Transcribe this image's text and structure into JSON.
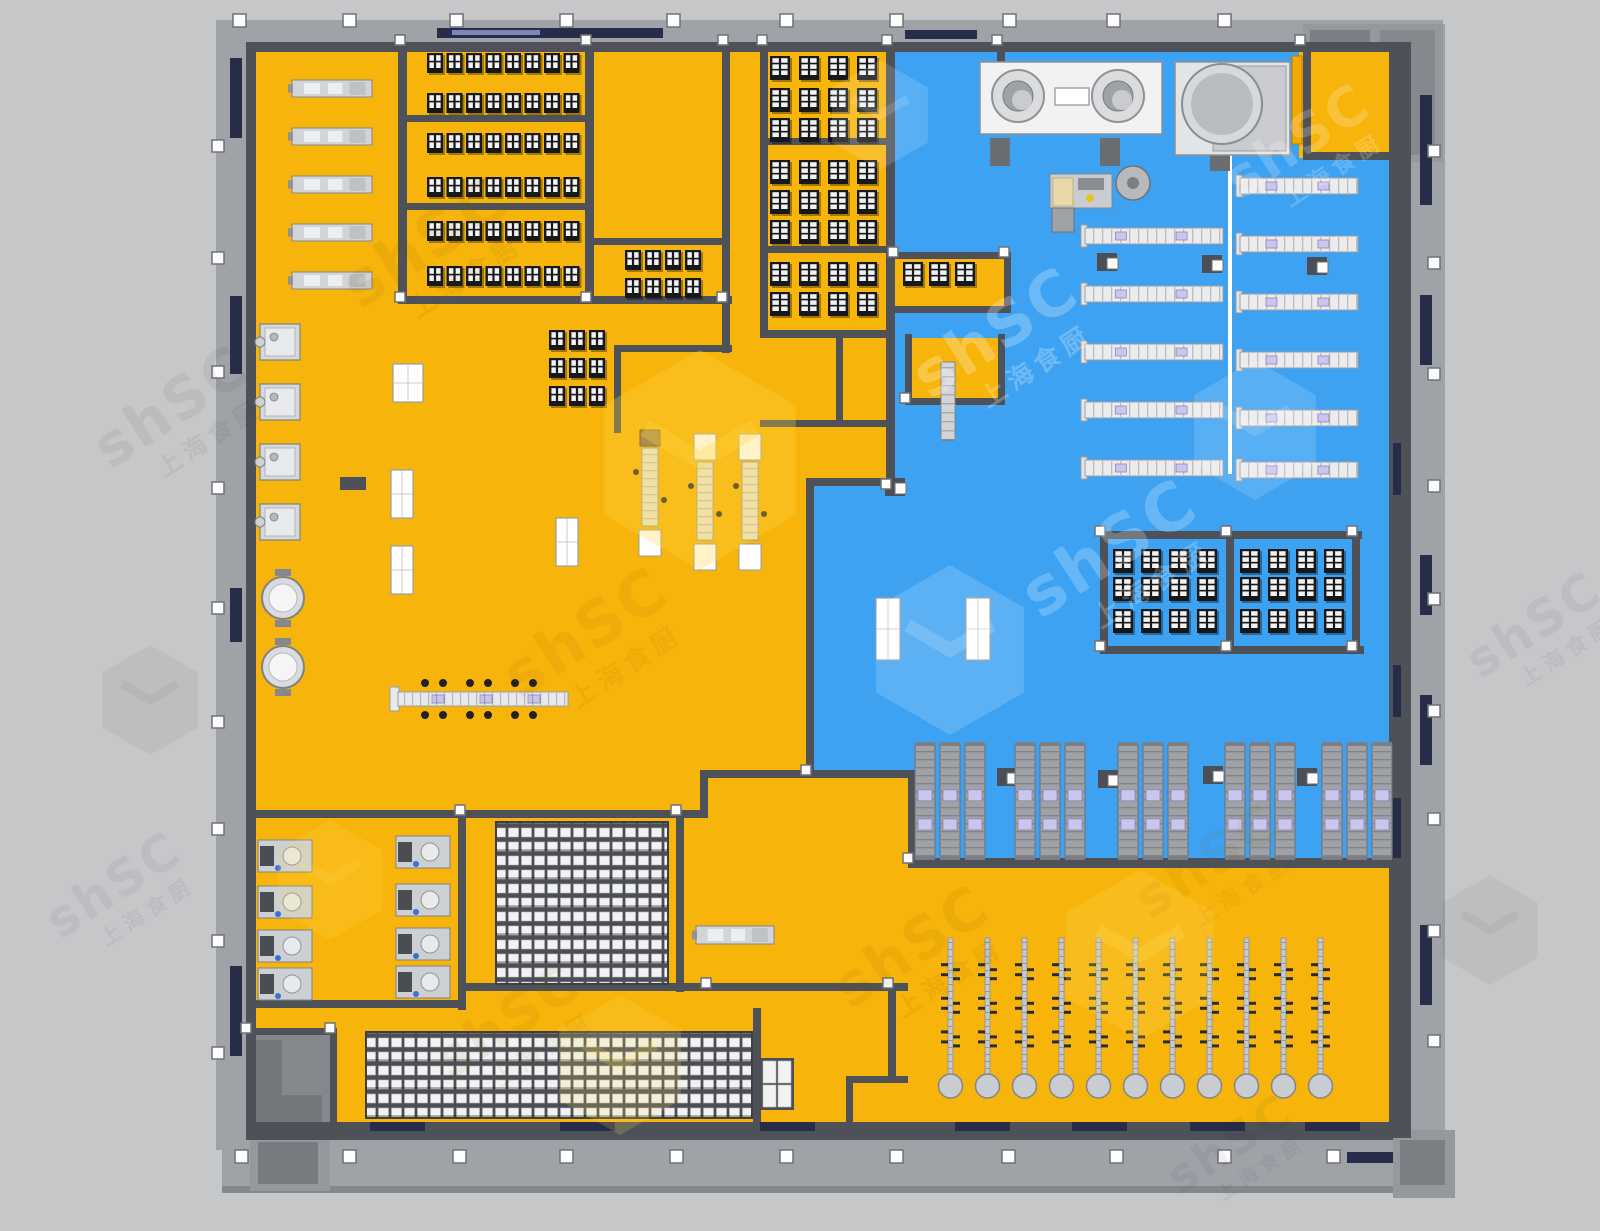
{
  "meta": {
    "width": 1600,
    "height": 1231,
    "bg": "#c6c7c9",
    "scene": "commercial-kitchen-floorplan-render"
  },
  "palette": {
    "yellow": "#F7B40A",
    "blue": "#3DA2F2",
    "wallDark": "#4E5258",
    "wallMid": "#6E7277",
    "facade": "#9FA2A7",
    "facadeDark": "#84878C",
    "navy": "#272C49",
    "white": "#FFFFFF",
    "silver": "#D2D4D7",
    "silverEdge": "#83868B",
    "rangeDark": "#17181A",
    "paneWhite": "#F2F2F3",
    "lavender": "#CBC6EE",
    "beige": "#EDE6D2",
    "trolley": "#9FA2A7",
    "colStroke": "#6E7176"
  },
  "watermark": {
    "latin": "shSC",
    "cjk": "上海食厨",
    "instances": [
      {
        "x": 110,
        "y": 470,
        "rot": -33,
        "size": 58,
        "color": "rgba(40,40,45,0.07)"
      },
      {
        "x": 360,
        "y": 310,
        "rot": -33,
        "size": 62,
        "color": "rgba(125,85,0,0.09)"
      },
      {
        "x": 520,
        "y": 700,
        "rot": -33,
        "size": 62,
        "color": "rgba(125,85,0,0.08)"
      },
      {
        "x": 930,
        "y": 400,
        "rot": -33,
        "size": 62,
        "color": "rgba(255,255,255,0.25)"
      },
      {
        "x": 1040,
        "y": 620,
        "rot": -33,
        "size": 66,
        "color": "rgba(255,255,255,0.22)"
      },
      {
        "x": 1240,
        "y": 200,
        "rot": -33,
        "size": 54,
        "color": "rgba(255,255,255,0.20)"
      },
      {
        "x": 850,
        "y": 1010,
        "rot": -33,
        "size": 58,
        "color": "rgba(125,85,0,0.09)"
      },
      {
        "x": 1150,
        "y": 920,
        "rot": -33,
        "size": 54,
        "color": "rgba(125,85,0,0.07)"
      },
      {
        "x": 450,
        "y": 1080,
        "rot": -33,
        "size": 54,
        "color": "rgba(125,85,0,0.08)"
      },
      {
        "x": 1480,
        "y": 680,
        "rot": -33,
        "size": 50,
        "color": "rgba(40,40,45,0.06)"
      },
      {
        "x": 60,
        "y": 940,
        "rot": -33,
        "size": 50,
        "color": "rgba(40,40,45,0.06)"
      },
      {
        "x": 1180,
        "y": 1195,
        "rot": -33,
        "size": 46,
        "color": "rgba(40,40,45,0.06)"
      }
    ],
    "cubes": [
      {
        "x": 700,
        "y": 460,
        "s": 110,
        "color": "rgba(255,215,70,0.30)"
      },
      {
        "x": 950,
        "y": 650,
        "s": 85,
        "color": "rgba(255,255,255,0.16)"
      },
      {
        "x": 1255,
        "y": 430,
        "s": 70,
        "color": "rgba(255,255,255,0.14)"
      },
      {
        "x": 880,
        "y": 115,
        "s": 55,
        "color": "rgba(255,255,255,0.14)"
      },
      {
        "x": 1140,
        "y": 955,
        "s": 85,
        "color": "rgba(255,225,100,0.22)"
      },
      {
        "x": 620,
        "y": 1065,
        "s": 70,
        "color": "rgba(255,225,100,0.18)"
      },
      {
        "x": 330,
        "y": 880,
        "s": 60,
        "color": "rgba(255,225,100,0.16)"
      },
      {
        "x": 1490,
        "y": 930,
        "s": 55,
        "color": "rgba(40,40,45,0.05)"
      },
      {
        "x": 150,
        "y": 700,
        "s": 55,
        "color": "rgba(40,40,45,0.05)"
      }
    ]
  },
  "floor": {
    "yellow": [
      251,
      47,
      1142,
      1080
    ],
    "blue_points": "893,47 1299,47 1299,158 1389,158 1389,862 908,862 908,772 810,772 810,482 893,482",
    "pockets": [
      [
        895,
        256,
        110,
        52
      ],
      [
        909,
        338,
        90,
        62
      ]
    ],
    "vestibule": [
      246,
      1032,
      86,
      104
    ]
  },
  "facade": {
    "top": [
      222,
      20,
      1221,
      24
    ],
    "left": [
      216,
      20,
      30,
      1130
    ],
    "bottom": [
      222,
      1140,
      1233,
      50
    ],
    "right": [
      1411,
      24,
      34,
      1136
    ],
    "bottom_edge": [
      222,
      1186,
      1233,
      7
    ],
    "corner_tr": [
      1303,
      24,
      140,
      138
    ],
    "corner_br": [
      1393,
      1130,
      62,
      68
    ],
    "stair_bl": [
      250,
      1133,
      80,
      58
    ]
  },
  "columns": {
    "top": {
      "y": 14,
      "xs": [
        233,
        343,
        450,
        560,
        667,
        780,
        890,
        1003,
        1107,
        1218
      ]
    },
    "bottom": {
      "y": 1150,
      "xs": [
        235,
        343,
        453,
        560,
        670,
        780,
        890,
        1002,
        1110,
        1218,
        1327
      ]
    },
    "left": {
      "x": 212,
      "ys": [
        140,
        252,
        366,
        482,
        602,
        716,
        823,
        935,
        1047
      ]
    },
    "right": {
      "x": 1428,
      "ys": [
        145,
        257,
        368,
        480,
        593,
        705,
        813,
        925,
        1035
      ]
    }
  },
  "walls": [
    [
      246,
      42,
      1147,
      10
    ],
    [
      246,
      42,
      10,
      1090
    ],
    [
      246,
      1122,
      1147,
      18
    ],
    [
      1389,
      42,
      22,
      1096
    ],
    [
      398,
      42,
      9,
      262
    ],
    [
      585,
      42,
      9,
      262
    ],
    [
      398,
      115,
      192,
      7
    ],
    [
      398,
      203,
      192,
      7
    ],
    [
      398,
      296,
      334,
      8
    ],
    [
      722,
      42,
      8,
      262
    ],
    [
      722,
      296,
      8,
      57
    ],
    [
      760,
      42,
      8,
      296
    ],
    [
      886,
      42,
      9,
      448
    ],
    [
      760,
      138,
      130,
      7
    ],
    [
      760,
      246,
      130,
      7
    ],
    [
      760,
      330,
      133,
      8
    ],
    [
      760,
      420,
      133,
      7
    ],
    [
      836,
      334,
      7,
      90
    ],
    [
      593,
      238,
      137,
      7
    ],
    [
      614,
      345,
      118,
      7
    ],
    [
      614,
      345,
      7,
      88
    ],
    [
      806,
      478,
      88,
      8
    ],
    [
      806,
      478,
      8,
      300
    ],
    [
      700,
      770,
      216,
      8
    ],
    [
      700,
      770,
      8,
      48
    ],
    [
      908,
      770,
      8,
      96
    ],
    [
      908,
      858,
      486,
      10
    ],
    [
      246,
      810,
      462,
      8
    ],
    [
      458,
      810,
      8,
      200
    ],
    [
      246,
      1000,
      218,
      8
    ],
    [
      676,
      810,
      8,
      182
    ],
    [
      466,
      983,
      442,
      8
    ],
    [
      753,
      1008,
      8,
      125
    ],
    [
      846,
      1076,
      7,
      58
    ],
    [
      846,
      1076,
      62,
      7
    ],
    [
      888,
      983,
      8,
      100
    ],
    [
      1100,
      531,
      262,
      8
    ],
    [
      1100,
      646,
      264,
      8
    ],
    [
      1100,
      531,
      8,
      123
    ],
    [
      1226,
      531,
      8,
      123
    ],
    [
      1352,
      531,
      8,
      123
    ],
    [
      893,
      252,
      118,
      7
    ],
    [
      893,
      306,
      118,
      7
    ],
    [
      1004,
      252,
      7,
      60
    ],
    [
      905,
      334,
      7,
      70
    ],
    [
      998,
      334,
      7,
      70
    ],
    [
      905,
      398,
      100,
      7
    ],
    [
      997,
      42,
      8,
      36
    ],
    [
      1303,
      42,
      8,
      118
    ],
    [
      1303,
      152,
      108,
      8
    ],
    [
      246,
      1028,
      90,
      7
    ],
    [
      330,
      1028,
      7,
      110
    ],
    [
      340,
      477,
      26,
      13
    ]
  ],
  "junction_cubes": [
    [
      400,
      40
    ],
    [
      586,
      40
    ],
    [
      723,
      40
    ],
    [
      762,
      40
    ],
    [
      887,
      40
    ],
    [
      997,
      40
    ],
    [
      1300,
      40
    ],
    [
      400,
      297
    ],
    [
      586,
      297
    ],
    [
      722,
      297
    ],
    [
      886,
      484
    ],
    [
      806,
      770
    ],
    [
      908,
      858
    ],
    [
      460,
      810
    ],
    [
      676,
      810
    ],
    [
      706,
      983
    ],
    [
      888,
      983
    ],
    [
      1100,
      531
    ],
    [
      1226,
      531
    ],
    [
      1352,
      531
    ],
    [
      1100,
      646
    ],
    [
      1226,
      646
    ],
    [
      1352,
      646
    ],
    [
      330,
      1028
    ],
    [
      246,
      1028
    ],
    [
      893,
      252
    ],
    [
      1004,
      252
    ],
    [
      905,
      398
    ]
  ],
  "slits": [
    [
      437,
      28,
      226,
      10
    ],
    [
      905,
      30,
      72,
      9
    ],
    [
      230,
      58,
      12,
      80
    ],
    [
      230,
      296,
      12,
      78
    ],
    [
      230,
      588,
      12,
      54
    ],
    [
      230,
      966,
      12,
      90
    ],
    [
      1393,
      443,
      8,
      52
    ],
    [
      1393,
      665,
      8,
      52
    ],
    [
      1393,
      798,
      8,
      60
    ],
    [
      1420,
      95,
      12,
      110
    ],
    [
      1420,
      295,
      12,
      70
    ],
    [
      1420,
      555,
      12,
      60
    ],
    [
      1420,
      695,
      12,
      70
    ],
    [
      1420,
      925,
      12,
      80
    ],
    [
      370,
      1122,
      55,
      9
    ],
    [
      560,
      1122,
      55,
      9
    ],
    [
      760,
      1122,
      55,
      9
    ],
    [
      955,
      1122,
      55,
      9
    ],
    [
      1072,
      1122,
      55,
      9
    ],
    [
      1190,
      1122,
      55,
      9
    ],
    [
      1305,
      1122,
      55,
      9
    ],
    [
      1347,
      1152,
      46,
      11
    ]
  ],
  "equipment": {
    "range_rows": [
      [
        427,
        53,
        8,
        19.5,
        16,
        20,
        2
      ],
      [
        427,
        93,
        8,
        19.5,
        16,
        20,
        2
      ],
      [
        427,
        133,
        8,
        19.5,
        16,
        20,
        2
      ],
      [
        427,
        177,
        8,
        19.5,
        16,
        20,
        2
      ],
      [
        427,
        221,
        8,
        19.5,
        16,
        20,
        2
      ],
      [
        427,
        266,
        8,
        19.5,
        16,
        20,
        2
      ],
      [
        625,
        250,
        4,
        20,
        16,
        20,
        2
      ],
      [
        625,
        278,
        4,
        20,
        16,
        20,
        2
      ],
      [
        549,
        330,
        3,
        20,
        16,
        20,
        2
      ],
      [
        549,
        358,
        3,
        20,
        16,
        20,
        2
      ],
      [
        549,
        386,
        3,
        20,
        16,
        20,
        2
      ],
      [
        770,
        56,
        4,
        29,
        20,
        24,
        3
      ],
      [
        770,
        88,
        4,
        29,
        20,
        24,
        3
      ],
      [
        770,
        118,
        4,
        29,
        20,
        24,
        3
      ],
      [
        770,
        160,
        4,
        29,
        20,
        24,
        3
      ],
      [
        770,
        190,
        4,
        29,
        20,
        24,
        3
      ],
      [
        770,
        220,
        4,
        29,
        20,
        24,
        3
      ],
      [
        770,
        262,
        4,
        29,
        20,
        24,
        3
      ],
      [
        770,
        292,
        4,
        29,
        20,
        24,
        3
      ],
      [
        903,
        262,
        3,
        26,
        20,
        24,
        3
      ],
      [
        1113,
        549,
        4,
        28,
        20,
        24,
        3
      ],
      [
        1113,
        577,
        4,
        28,
        20,
        24,
        3
      ],
      [
        1113,
        609,
        4,
        28,
        20,
        24,
        3
      ],
      [
        1240,
        549,
        4,
        28,
        20,
        24,
        3
      ],
      [
        1240,
        577,
        4,
        28,
        20,
        24,
        3
      ],
      [
        1240,
        609,
        4,
        28,
        20,
        24,
        3
      ]
    ],
    "silver_machines": [
      [
        292,
        80,
        80,
        17
      ],
      [
        292,
        128,
        80,
        17
      ],
      [
        292,
        176,
        80,
        17
      ],
      [
        292,
        224,
        80,
        17
      ],
      [
        292,
        272,
        80,
        17
      ],
      [
        696,
        926,
        78,
        18
      ]
    ],
    "steamers": [
      [
        260,
        324
      ],
      [
        260,
        384
      ],
      [
        260,
        444
      ],
      [
        260,
        504
      ]
    ],
    "kettles": [
      [
        283,
        598
      ],
      [
        283,
        667
      ]
    ],
    "tilt_kettles": [
      [
        258,
        840
      ],
      [
        258,
        886
      ],
      [
        258,
        930
      ],
      [
        258,
        968
      ],
      [
        396,
        836
      ],
      [
        396,
        884
      ],
      [
        396,
        928
      ],
      [
        396,
        966
      ]
    ],
    "proc_lines": [
      [
        642,
        448,
        1
      ],
      [
        697,
        462,
        0
      ],
      [
        742,
        462,
        0
      ]
    ],
    "tables": [
      [
        393,
        364,
        30,
        38
      ],
      [
        391,
        470,
        22,
        48
      ],
      [
        391,
        546,
        22,
        48
      ],
      [
        556,
        518,
        22,
        48
      ],
      [
        876,
        598,
        24,
        62
      ],
      [
        966,
        598,
        24,
        62
      ]
    ],
    "pocket_trolleys": [
      [
        941,
        362,
        14,
        78
      ]
    ],
    "small_racks": [
      [
        762,
        1060,
        30,
        48
      ]
    ],
    "packing_line": {
      "x": 398,
      "y": 692,
      "w": 170,
      "h": 14,
      "screens": [
        432,
        480,
        528
      ],
      "chairs": [
        425,
        443,
        470,
        488,
        515,
        533
      ]
    },
    "bench_rows": [
      [
        1085,
        228,
        138
      ],
      [
        1085,
        286,
        138
      ],
      [
        1085,
        344,
        138
      ],
      [
        1085,
        402,
        138
      ],
      [
        1085,
        460,
        138
      ],
      [
        1240,
        178,
        118
      ],
      [
        1240,
        236,
        118
      ],
      [
        1240,
        294,
        118
      ],
      [
        1240,
        352,
        118
      ],
      [
        1240,
        410,
        118
      ],
      [
        1240,
        462,
        118
      ]
    ],
    "rail": [
      1228,
      148,
      4,
      326
    ],
    "mixer": {
      "base": [
        1050,
        174,
        62,
        34
      ],
      "tray": [
        1053,
        178,
        20,
        28
      ],
      "steps": [
        1052,
        208,
        22,
        24
      ],
      "head": [
        1133,
        183,
        17
      ]
    },
    "dish": {
      "counter": [
        980,
        62,
        182,
        72
      ],
      "donuts": [
        [
          1018,
          96
        ],
        [
          1118,
          96
        ]
      ],
      "sq": [
        1055,
        88,
        34,
        17
      ],
      "legs": [
        [
          990,
          138
        ],
        [
          1100,
          138
        ],
        [
          1210,
          143
        ]
      ],
      "machine2": [
        1175,
        62,
        115,
        93
      ],
      "drum": [
        1222,
        104,
        40
      ],
      "orange": [
        1292,
        56,
        10,
        88
      ]
    },
    "door_cubes": [
      [
        1097,
        253
      ],
      [
        1202,
        255
      ],
      [
        1307,
        257
      ],
      [
        997,
        768
      ],
      [
        1098,
        770
      ],
      [
        1203,
        766
      ],
      [
        1297,
        768
      ],
      [
        885,
        478
      ]
    ],
    "trolley_groups": {
      "xs": [
        915,
        1015,
        1118,
        1225,
        1322
      ],
      "y": 745,
      "bar_w": 20,
      "bar_h": 112,
      "gap": 5
    },
    "hang_racks": {
      "x0": 948,
      "step": 37,
      "n": 11,
      "y": 938,
      "h": 140
    },
    "grids": [
      [
        496,
        822,
        172,
        162
      ],
      [
        366,
        1032,
        386,
        86
      ]
    ]
  }
}
